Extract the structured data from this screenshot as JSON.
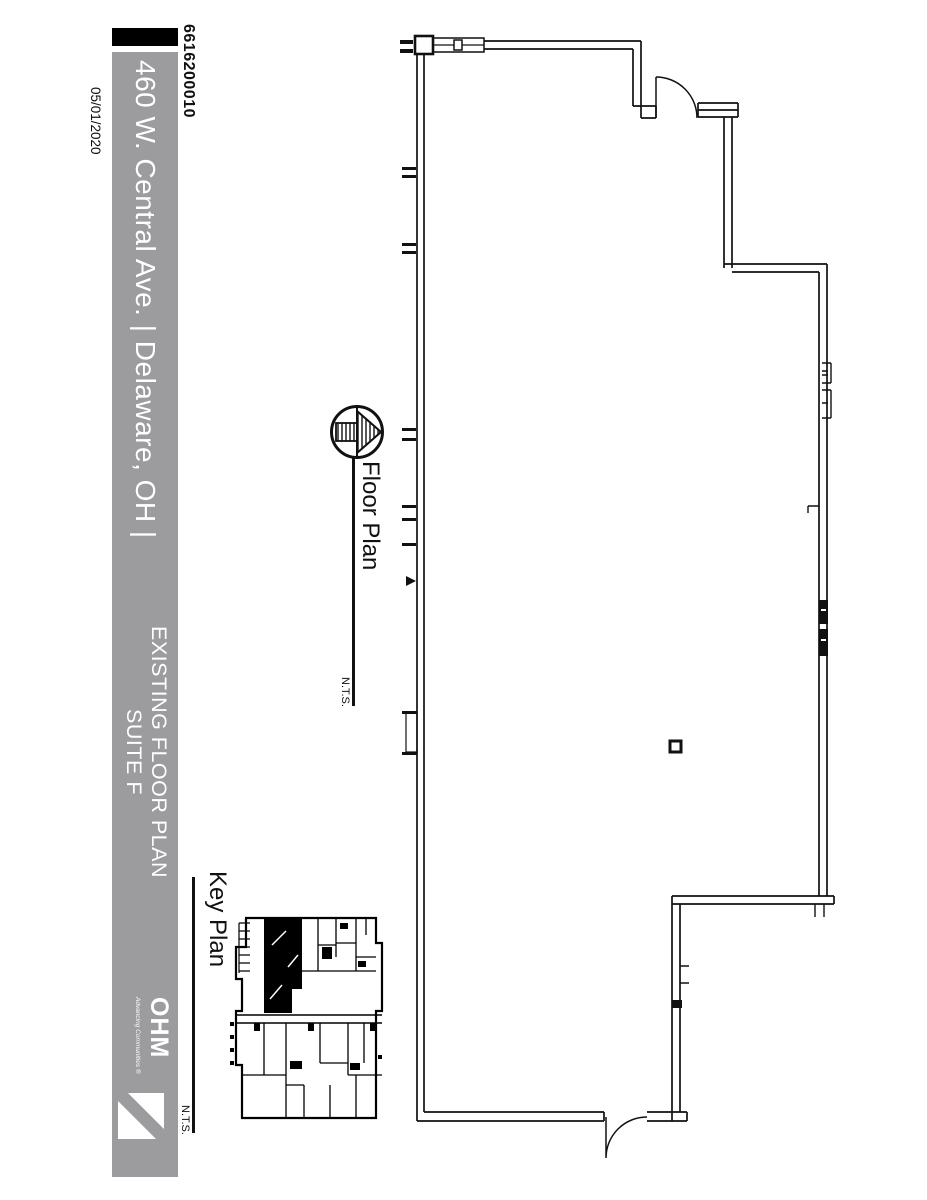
{
  "sheet": {
    "project_number": "6616200010",
    "date": "05/01/2020",
    "title_bar": {
      "address": "460 W. Central Ave. | Delaware, OH |",
      "drawing_title_line1": "EXISTING FLOOR PLAN",
      "drawing_title_line2": "SUITE F",
      "logo_name": "OHM",
      "logo_tagline": "Advancing Communities ®"
    },
    "views": {
      "floor_plan": {
        "label": "Floor Plan",
        "scale_note": "N.T.S."
      },
      "key_plan": {
        "label": "Key Plan",
        "scale_note": "N.T.S."
      }
    },
    "colors": {
      "title_bar_gray": "#9c9c9e",
      "ink": "#111111",
      "suite_highlight": "#000000"
    }
  }
}
